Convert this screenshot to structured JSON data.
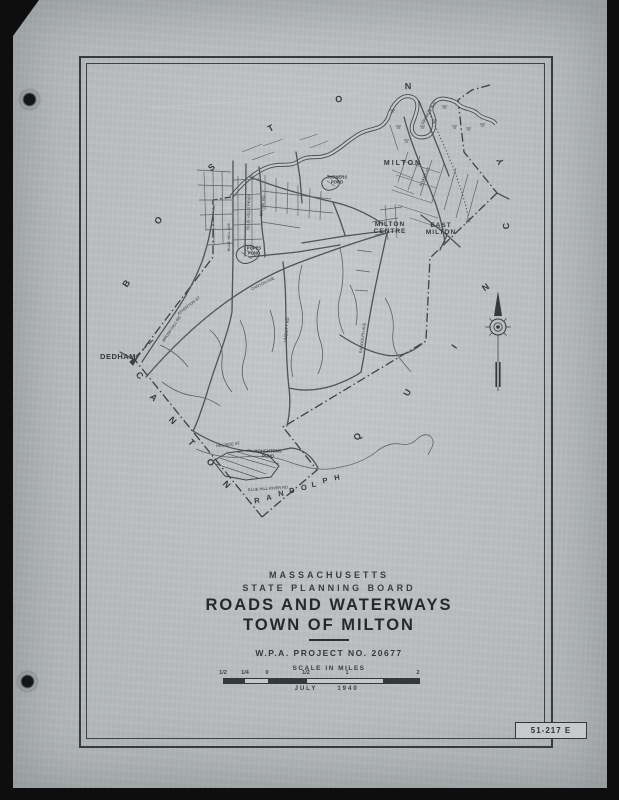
{
  "sheet": {
    "plate_number": "51-217 E"
  },
  "title_block": {
    "line1": "MASSACHUSETTS",
    "line2": "STATE  PLANNING  BOARD",
    "line3": "ROADS AND WATERWAYS",
    "line4": "TOWN OF MILTON",
    "wpa_line": "W.P.A.  PROJECT   NO.  20677"
  },
  "scale_bar": {
    "title": "SCALE  IN  MILES",
    "ticks": [
      {
        "label": "1/2",
        "x": 223
      },
      {
        "label": "1/4",
        "x": 245
      },
      {
        "label": "0",
        "x": 267
      },
      {
        "label": "1/2",
        "x": 306
      },
      {
        "label": "1",
        "x": 347
      },
      {
        "label": "2",
        "x": 418
      }
    ],
    "date_month": "JULY",
    "date_year": "1940"
  },
  "map": {
    "towns": [
      {
        "name": "boston",
        "letters": [
          {
            "ch": "B",
            "x": 127,
            "y": 284,
            "r": -55
          },
          {
            "ch": "O",
            "x": 159,
            "y": 221,
            "r": -47
          },
          {
            "ch": "S",
            "x": 212,
            "y": 168,
            "r": -38
          },
          {
            "ch": "T",
            "x": 271,
            "y": 129,
            "r": -28
          },
          {
            "ch": "O",
            "x": 339,
            "y": 100,
            "r": -14
          },
          {
            "ch": "N",
            "x": 408,
            "y": 87,
            "r": -2
          }
        ]
      },
      {
        "name": "quincy",
        "letters": [
          {
            "ch": "Q",
            "x": 358,
            "y": 437,
            "r": -55
          },
          {
            "ch": "U",
            "x": 408,
            "y": 393,
            "r": -62
          },
          {
            "ch": "I",
            "x": 455,
            "y": 347,
            "r": -55
          },
          {
            "ch": "N",
            "x": 486,
            "y": 288,
            "r": -35
          },
          {
            "ch": "C",
            "x": 507,
            "y": 226,
            "r": -95
          },
          {
            "ch": "Y",
            "x": 501,
            "y": 161,
            "r": -115
          }
        ]
      },
      {
        "name": "canton",
        "letters": [
          {
            "ch": "C",
            "x": 139,
            "y": 376,
            "r": 45
          },
          {
            "ch": "A",
            "x": 153,
            "y": 398,
            "r": 45
          },
          {
            "ch": "N",
            "x": 172,
            "y": 421,
            "r": 45
          },
          {
            "ch": "T",
            "x": 191,
            "y": 443,
            "r": 45
          },
          {
            "ch": "O",
            "x": 210,
            "y": 463,
            "r": 45
          },
          {
            "ch": "N",
            "x": 226,
            "y": 485,
            "r": 45
          }
        ]
      },
      {
        "name": "randolph",
        "letters": [
          {
            "ch": "R",
            "x": 257,
            "y": 501,
            "r": -9
          },
          {
            "ch": "A",
            "x": 269,
            "y": 498,
            "r": -9
          },
          {
            "ch": "N",
            "x": 281,
            "y": 494,
            "r": -9
          },
          {
            "ch": "D",
            "x": 292,
            "y": 491,
            "r": -9
          },
          {
            "ch": "O",
            "x": 304,
            "y": 488,
            "r": -9
          },
          {
            "ch": "L",
            "x": 314,
            "y": 485,
            "r": -9
          },
          {
            "ch": "P",
            "x": 325,
            "y": 481,
            "r": -9
          },
          {
            "ch": "H",
            "x": 337,
            "y": 478,
            "r": -9
          }
        ]
      }
    ],
    "place_labels": [
      {
        "id": "dedham",
        "text": "DEDHAM",
        "x": 118,
        "y": 357,
        "size": 7.5,
        "r": 0,
        "ls": 0.5
      },
      {
        "id": "milton",
        "text": "MILTON",
        "x": 403,
        "y": 164,
        "size": 7,
        "r": 0,
        "ls": 2
      },
      {
        "id": "milton-centre",
        "text": "MILTON\nCENTRE",
        "x": 390,
        "y": 228,
        "size": 6.5,
        "r": 0,
        "ls": 1
      },
      {
        "id": "east-milton",
        "text": "EAST\nMILTON",
        "x": 441,
        "y": 229,
        "size": 6.5,
        "r": 0,
        "ls": 1
      },
      {
        "id": "popes-pond",
        "text": "POPES\nPOND",
        "x": 254,
        "y": 251,
        "size": 4.2,
        "r": 0,
        "ls": 0
      },
      {
        "id": "turners-pond",
        "text": "TURNERS\nPOND",
        "x": 337,
        "y": 180,
        "size": 4.2,
        "r": 0,
        "ls": 0
      },
      {
        "id": "houghtons-pond",
        "text": "HOUGHTONS\nPOND",
        "x": 268,
        "y": 454,
        "size": 4.2,
        "r": 0,
        "ls": 0
      }
    ],
    "road_labels": [
      {
        "text": "BROOK RD",
        "x": 263,
        "y": 206,
        "r": -82
      },
      {
        "text": "BLUE HILL AVE",
        "x": 229,
        "y": 237,
        "r": -90
      },
      {
        "text": "BLUE HILLS PKWY",
        "x": 249,
        "y": 212,
        "r": -88
      },
      {
        "text": "CANTON AVE",
        "x": 263,
        "y": 284,
        "r": -27
      },
      {
        "text": "ATHERTON ST",
        "x": 189,
        "y": 306,
        "r": -38
      },
      {
        "text": "BRUSH HILL RD",
        "x": 172,
        "y": 329,
        "r": -56
      },
      {
        "text": "UNQUITY RD",
        "x": 287,
        "y": 330,
        "r": -84
      },
      {
        "text": "RANDOLPH AVE",
        "x": 363,
        "y": 338,
        "r": -83
      },
      {
        "text": "ADAMS ST",
        "x": 425,
        "y": 177,
        "r": -65
      },
      {
        "text": "GRANITE AVE",
        "x": 429,
        "y": 113,
        "r": -60
      },
      {
        "text": "HILLSIDE ST",
        "x": 228,
        "y": 445,
        "r": -7
      },
      {
        "text": "BLUE HILL RIVER RD",
        "x": 268,
        "y": 489,
        "r": -4
      }
    ]
  }
}
